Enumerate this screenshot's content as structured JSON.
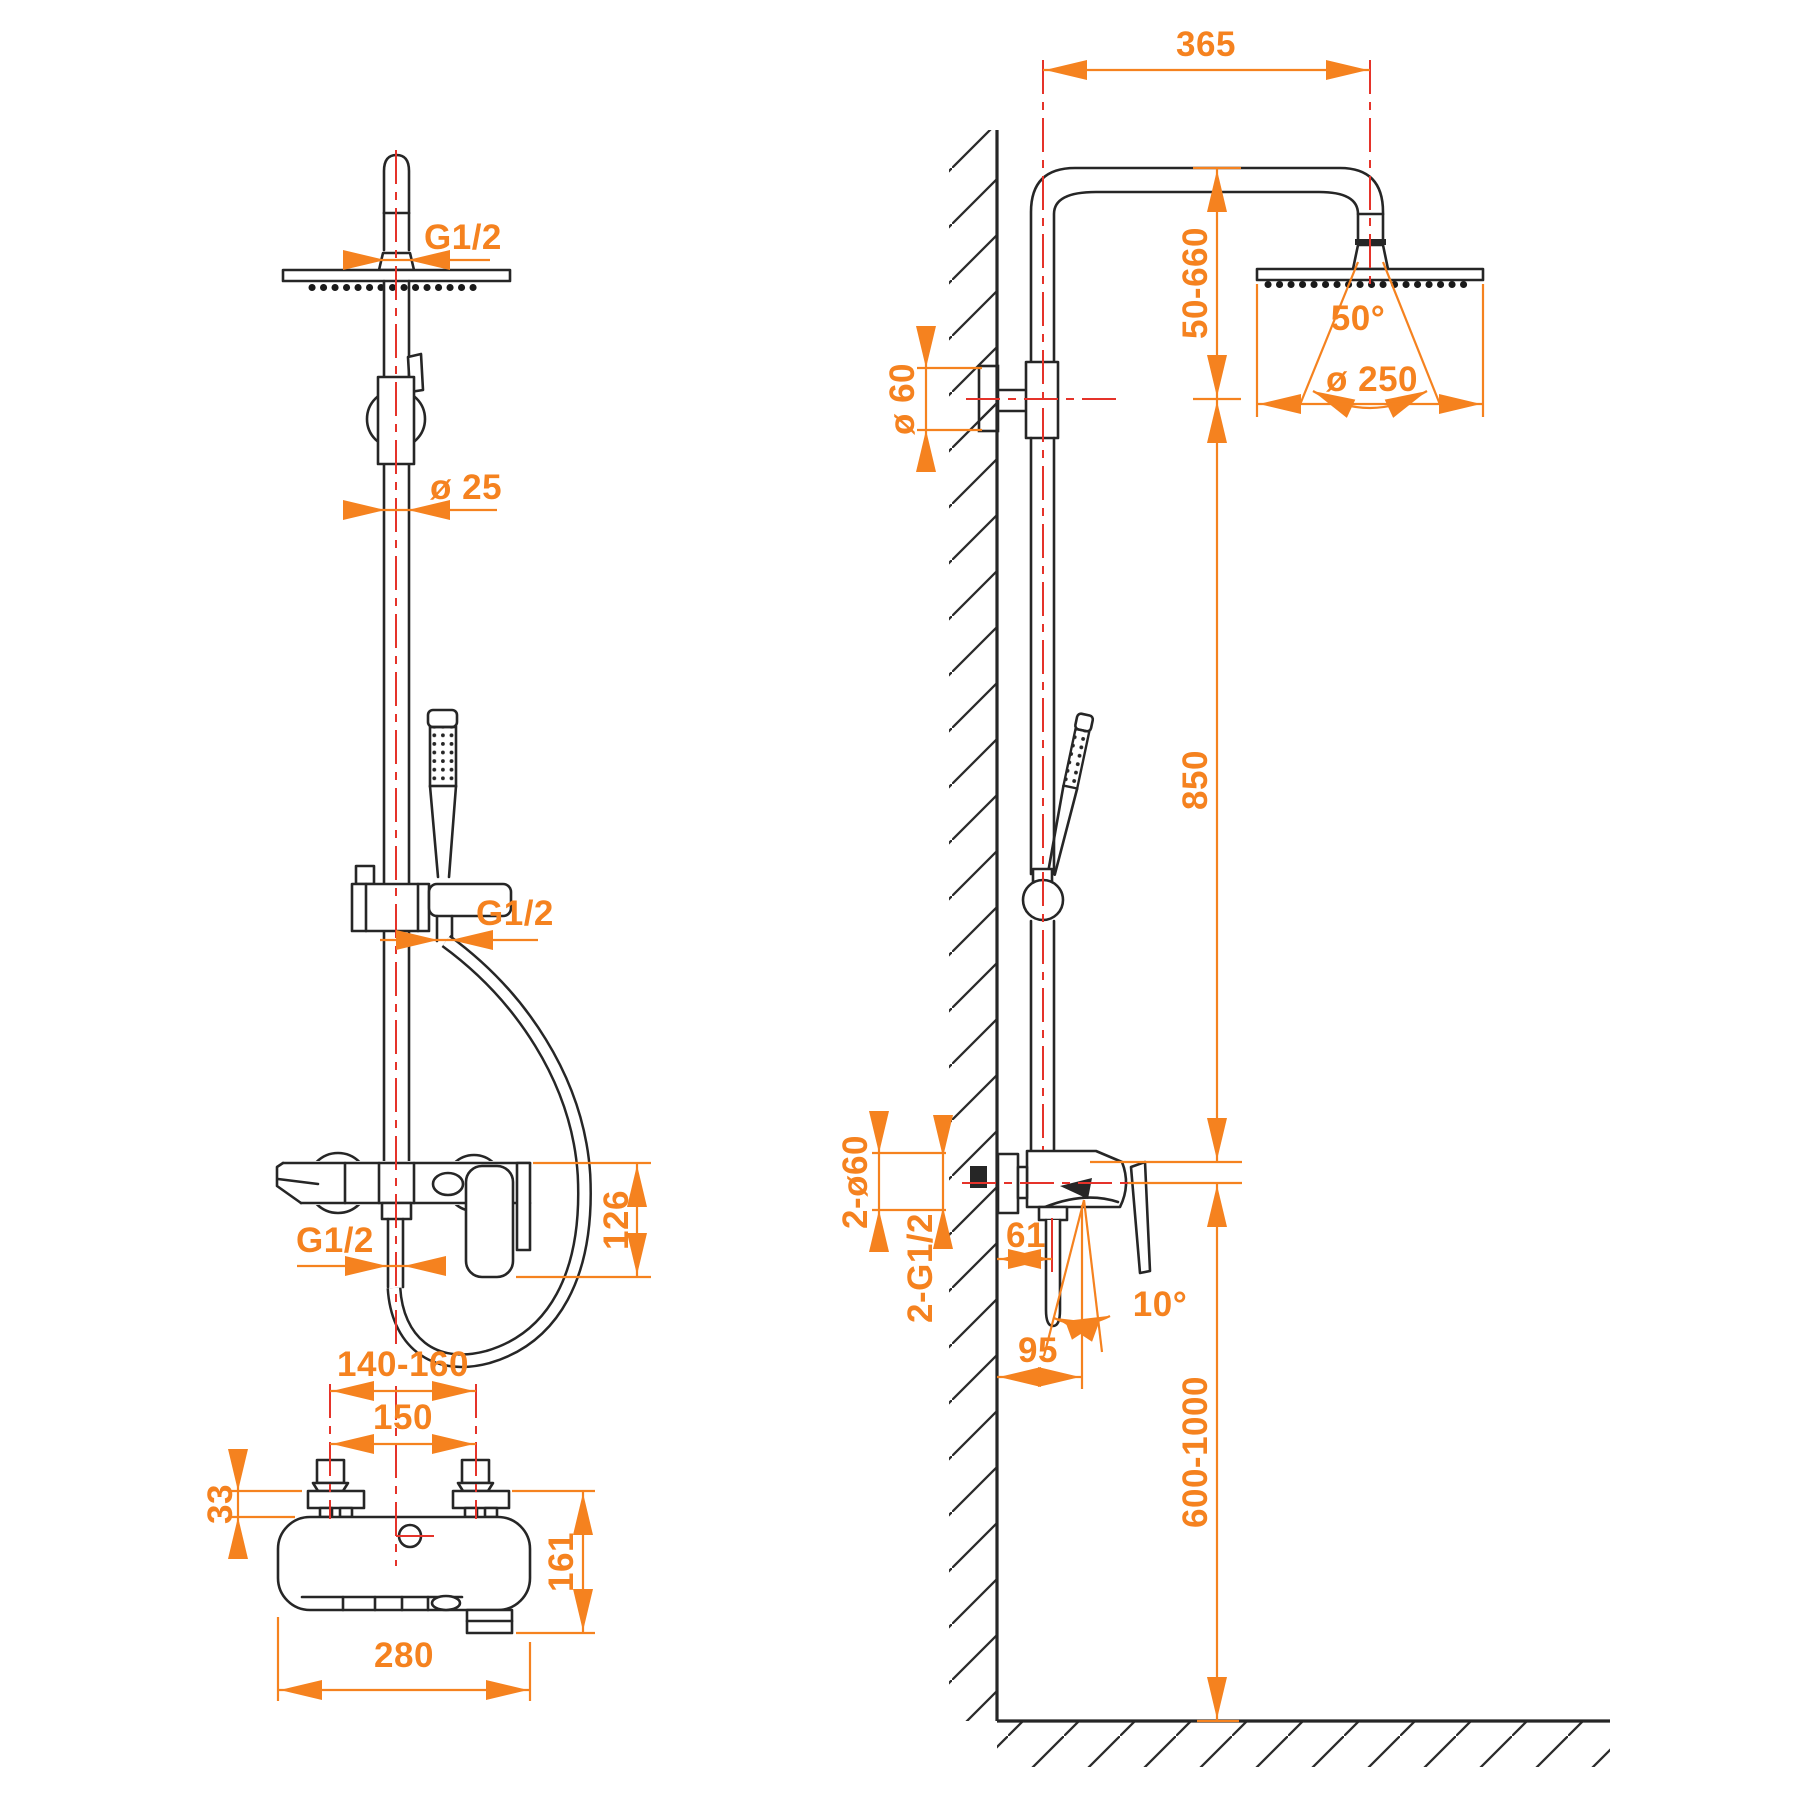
{
  "colors": {
    "dimension": "#F5821F",
    "centerline": "#E5332A",
    "outline": "#262626",
    "background": "#FFFFFF"
  },
  "front": {
    "g12_head": "G1/2",
    "dia25": "ø 25",
    "g12_hose": "G1/2",
    "dim126": "126",
    "g12_outlet": "G1/2",
    "dim140_160": "140-160",
    "dim150": "150",
    "dim33": "33",
    "dim161": "161",
    "dim280": "280"
  },
  "side": {
    "dim365": "365",
    "dim50_660": "50-660",
    "dia60": "ø 60",
    "angle50": "50°",
    "dia250": "ø 250",
    "dim850": "850",
    "dim2_dia60": "2-ø60",
    "dim2_g12": "2-G1/2",
    "dim61": "61",
    "angle10": "10°",
    "dim95": "95",
    "dim600_1000": "600-1000"
  }
}
